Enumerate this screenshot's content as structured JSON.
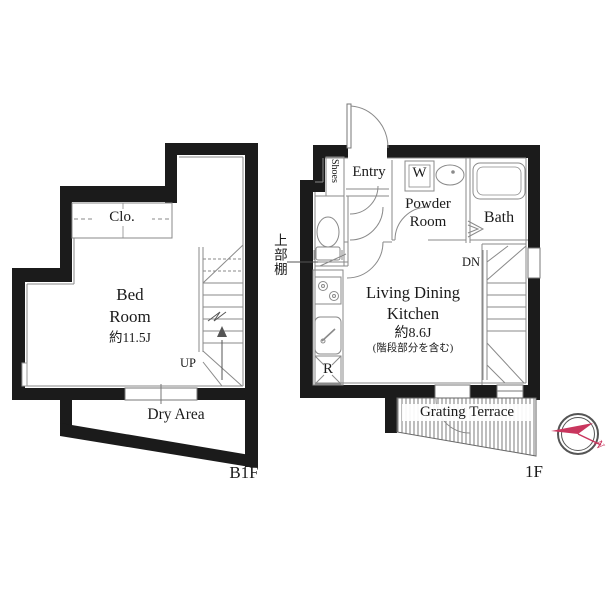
{
  "b1f": {
    "floor_label": "B1F",
    "bedroom_line1": "Bed",
    "bedroom_line2": "Room",
    "bedroom_area": "約11.5J",
    "closet": "Clo.",
    "dry_area": "Dry Area",
    "stairs_up": "UP"
  },
  "f1": {
    "floor_label": "1F",
    "entry": "Entry",
    "shoe_cabinet": "Shoes",
    "washer": "W",
    "powder_line1": "Powder",
    "powder_line2": "Room",
    "bath": "Bath",
    "ldk_line1": "Living Dining",
    "ldk_line2": "Kitchen",
    "ldk_area": "約8.6J",
    "ldk_area_note": "(階段部分を含む)",
    "refrigerator": "R",
    "terrace": "Grating Terrace",
    "stairs_down": "DN",
    "upper_shelf": "上部棚"
  },
  "compass": {
    "north_label": "N"
  },
  "colors": {
    "wall": "#1b1b1b",
    "thin_line": "#8a8a8a",
    "compass_accent": "#c9365e"
  }
}
